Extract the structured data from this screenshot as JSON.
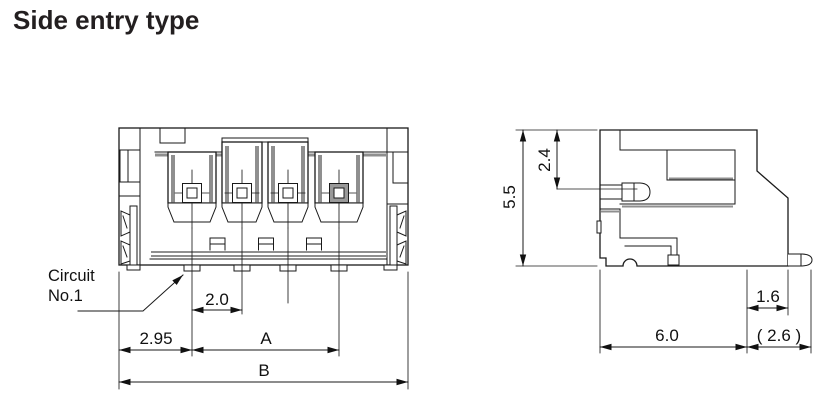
{
  "title": "Side entry type",
  "drawing": {
    "circuit_label": {
      "line1": "Circuit",
      "line2": "No.1"
    },
    "front_view": {
      "dim_pitch": "2.0",
      "dim_edge_to_pin1": "2.95",
      "dim_span_a": "A",
      "dim_overall_b": "B"
    },
    "side_view": {
      "dim_height": "5.5",
      "dim_pin_offset": "2.4",
      "dim_lead": "1.6",
      "dim_depth": "6.0",
      "dim_overhang": "( 2.6 )"
    },
    "colors": {
      "line": "#1a1a1a",
      "shade": "#8f8f8f",
      "background": "#ffffff"
    }
  }
}
